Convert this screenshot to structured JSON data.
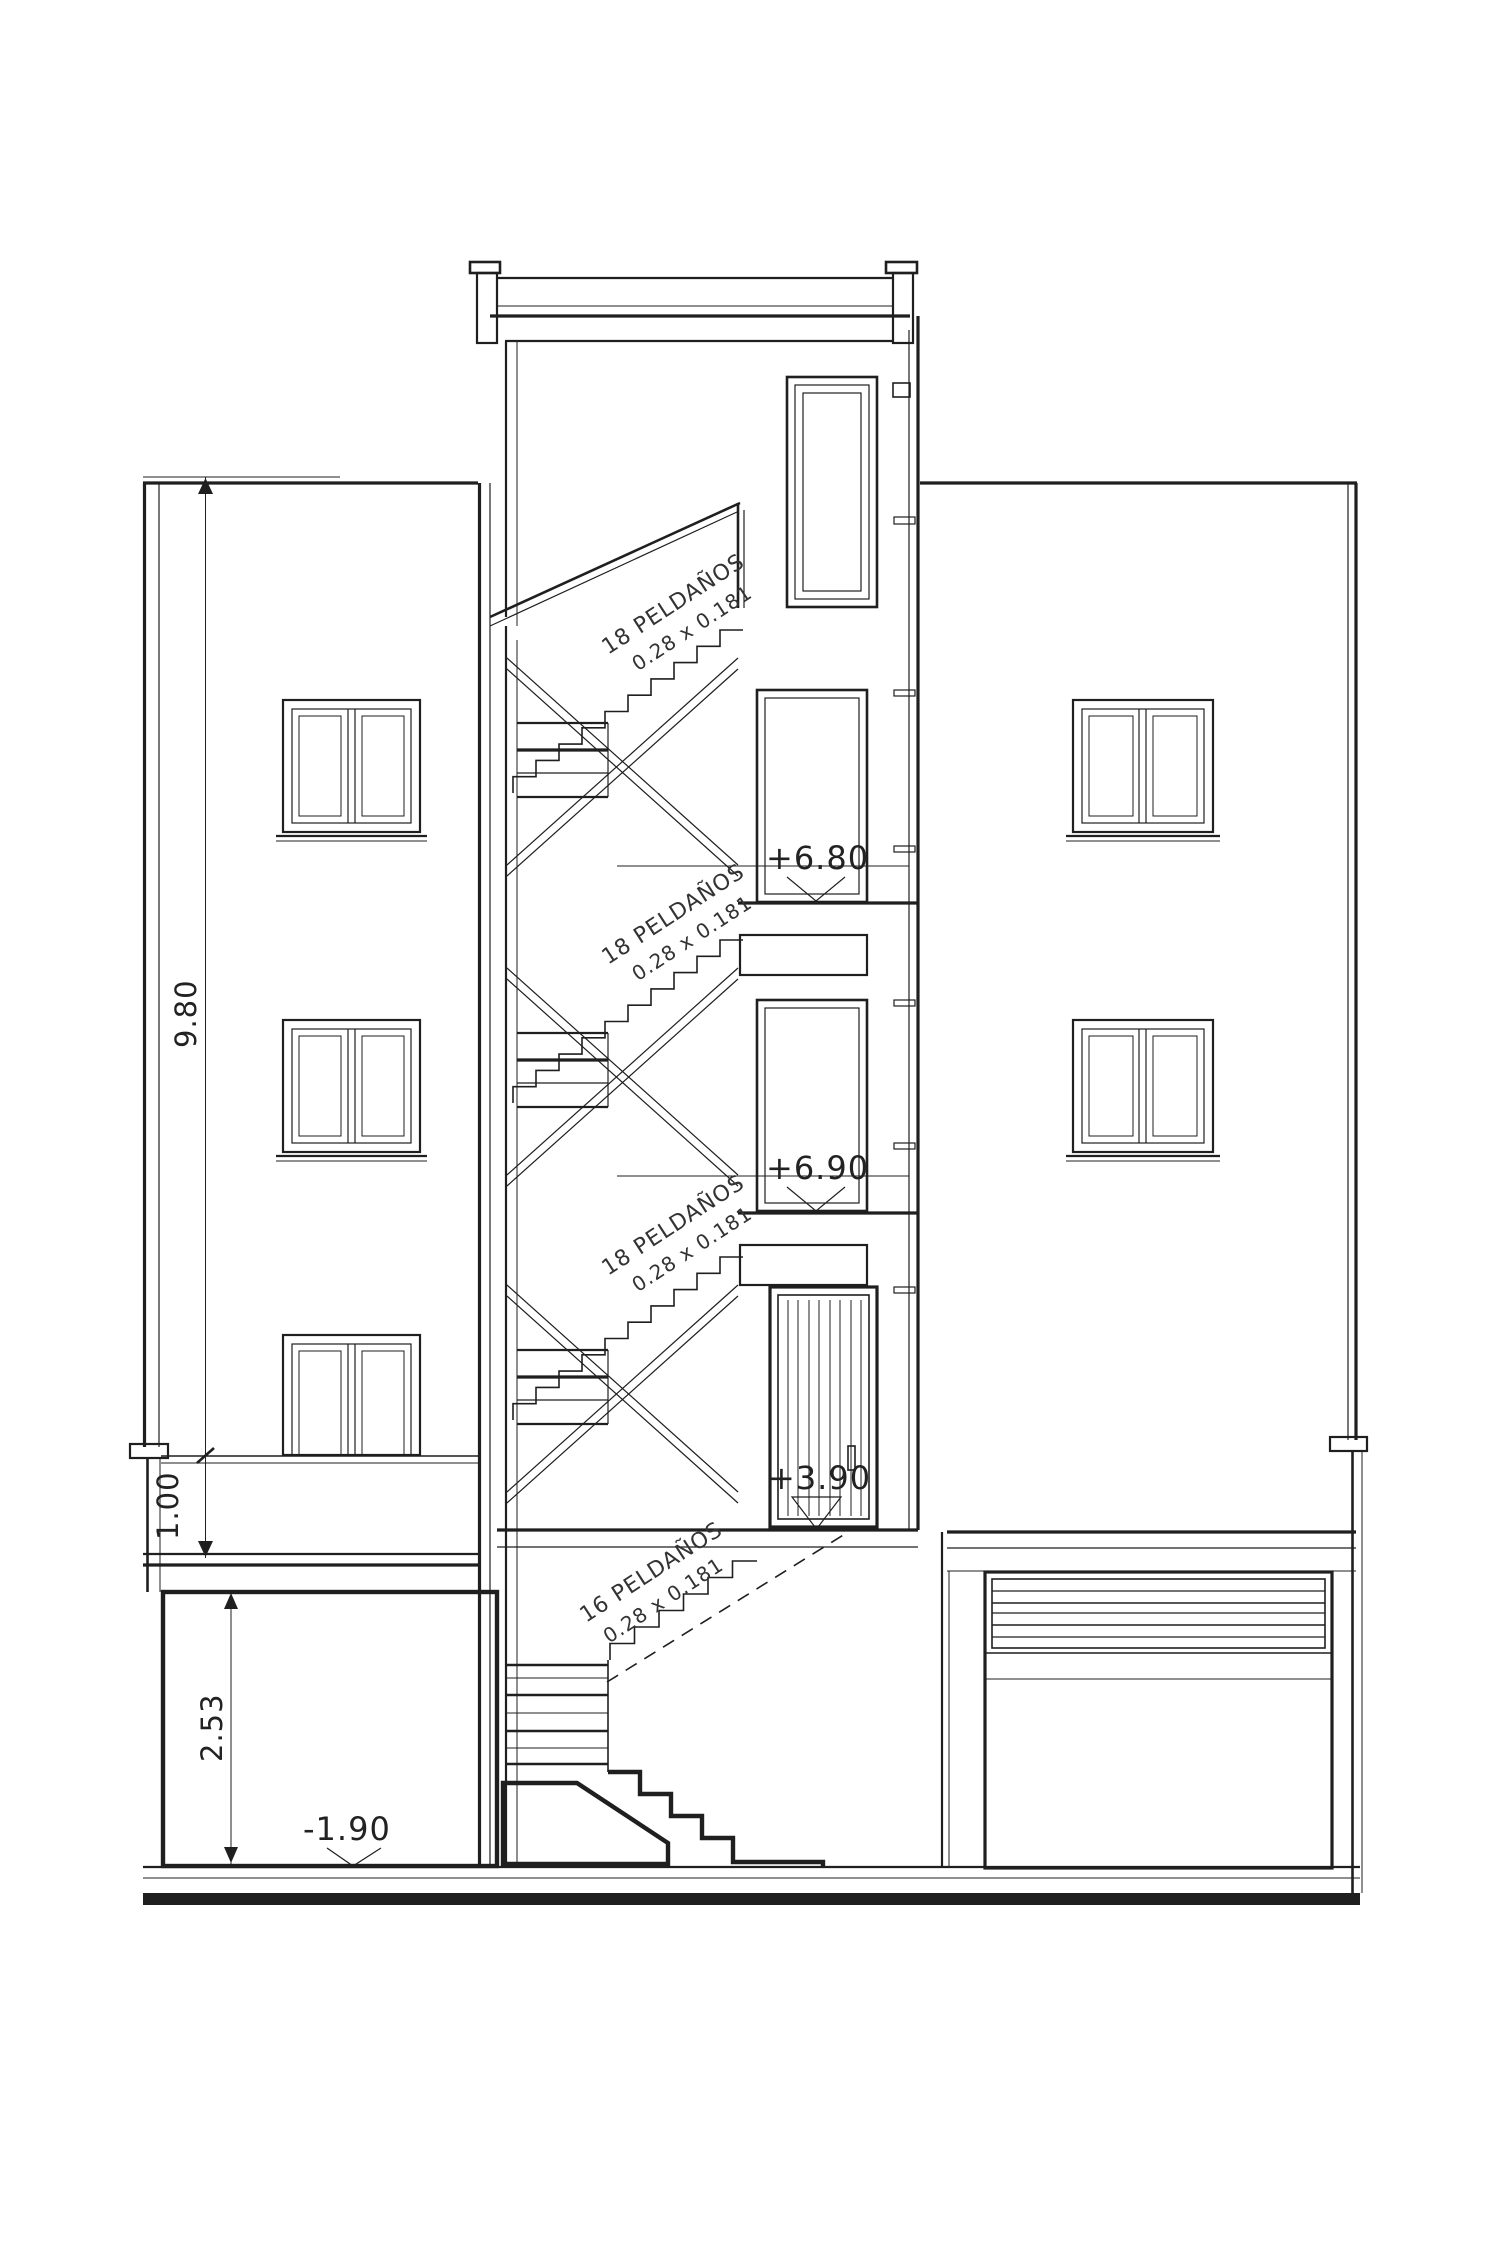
{
  "drawing": {
    "type": "building-section-elevation",
    "levels": {
      "third_floor": "+6.80",
      "second_floor": "+6.90",
      "first_floor": "+3.90",
      "basement": "-1.90"
    },
    "dimensions": {
      "total_height": "9.80",
      "terrace_height": "1.00",
      "basement_height": "2.53"
    },
    "stairs": {
      "flight_top": {
        "steps": "18 PELDAÑOS",
        "tread": "0.28 x 0.181"
      },
      "flight_mid": {
        "steps": "18 PELDAÑOS",
        "tread": "0.28 x 0.181"
      },
      "flight_low": {
        "steps": "18 PELDAÑOS",
        "tread": "0.28 x 0.181"
      },
      "flight_basement": {
        "steps": "16 PELDAÑOS",
        "tread": "0.28 x 0.181"
      }
    },
    "colors": {
      "line": "#1f1f1f",
      "background": "#ffffff"
    }
  }
}
